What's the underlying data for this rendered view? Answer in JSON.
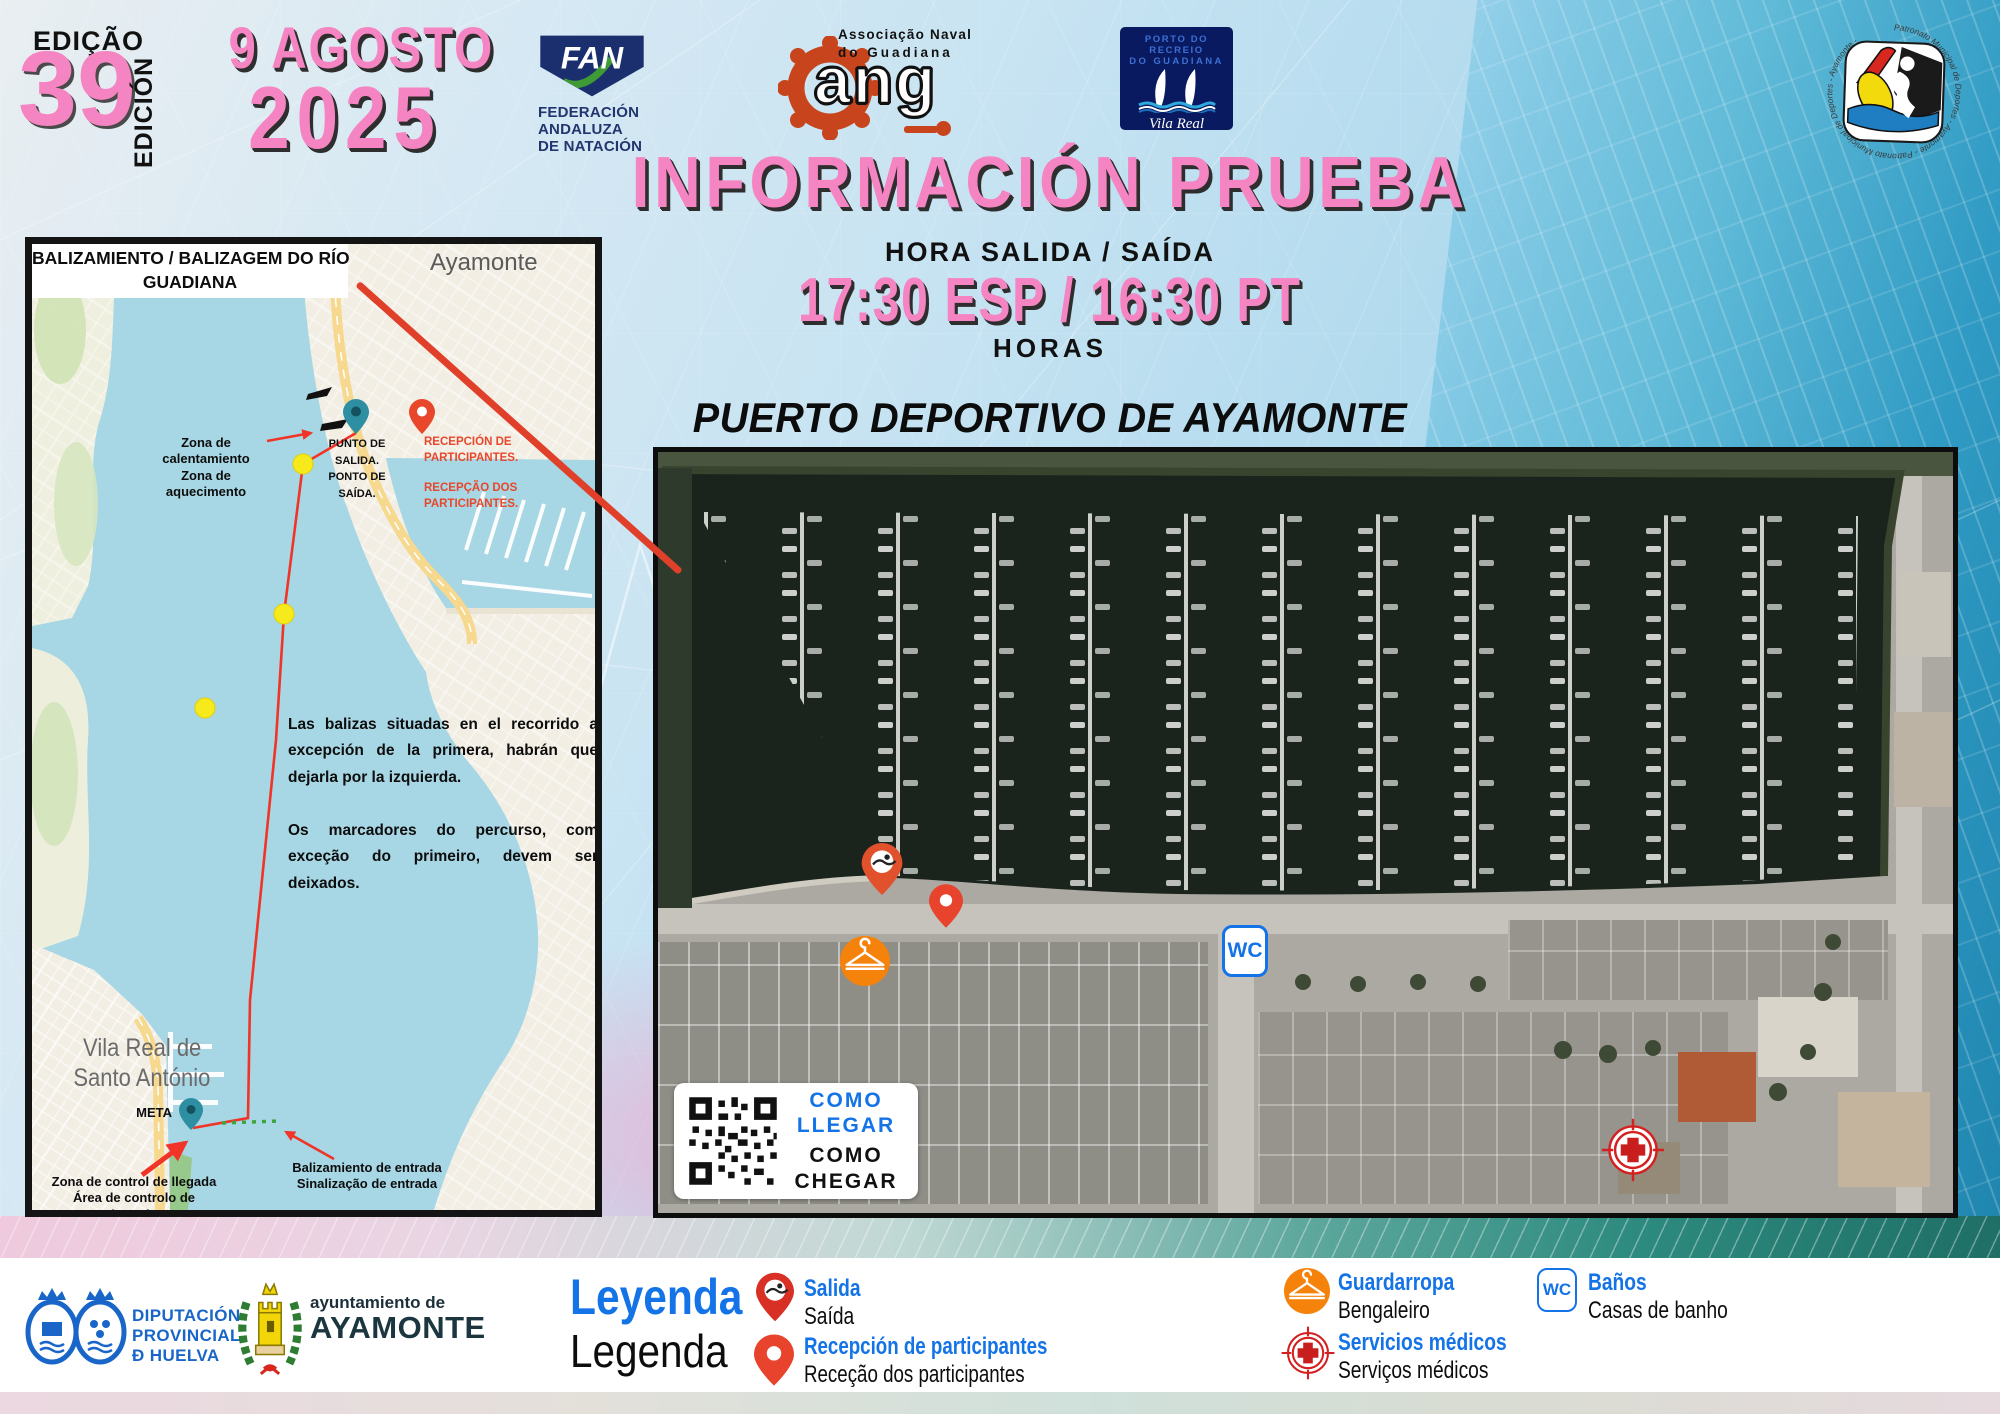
{
  "colors": {
    "pink": "#F584C2",
    "navy": "#1B2F6E",
    "legend_blue": "#1473E6",
    "orange": "#F5820B",
    "pin_red": "#E2402A",
    "teal_pin": "#2E8FA3",
    "route_red": "#F03428",
    "map_water": "#A7D6E4",
    "marina_dark": "#1B241C"
  },
  "edition": {
    "label_top": "EDIÇÃO",
    "number": "39",
    "label_side": "EDICIÓN"
  },
  "event_date": {
    "line1": "9 AGOSTO",
    "line2": "2025"
  },
  "logos": {
    "fan": {
      "acronym": "FAN",
      "line1": "FEDERACIÓN",
      "line2": "ANDALUZA",
      "line3": "DE NATACIÓN"
    },
    "ang": {
      "line1": "Associação Naval",
      "line2": "do Guadiana",
      "acronym": "ang"
    },
    "porto": {
      "line1": "PORTO DO RECREIO",
      "line2": "DO GUADIANA",
      "script": "Vila Real",
      "sub1": "DE SANTO ANTÓNIO",
      "sub2": "ALGARVE"
    },
    "patronato": {
      "circular_text": "Patronato Municipal de Deportes - Ayamonte - Patronato Municipal de Deportes - Ayamonte -"
    },
    "diputacion": {
      "line1": "DIPUTACIÓN",
      "line2": "PROVINCIAL",
      "line3": "Ð HUELVA"
    },
    "ayuntamiento": {
      "line1": "ayuntamiento de",
      "line2": "AYAMONTE"
    }
  },
  "header": {
    "title": "INFORMACIÓN PRUEBA",
    "departure_label": "HORA SALIDA / SAÍDA",
    "departure_time": "17:30 ESP / 16:30 PT",
    "hours_label": "HORAS",
    "venue": "PUERTO DEPORTIVO DE AYAMONTE"
  },
  "route_map": {
    "title_line1": "BALIZAMIENTO / BALIZAGEM DO RÍO",
    "title_line2": "GUADIANA",
    "city_top": "Ayamonte",
    "warmup_es": "Zona de calentamiento",
    "warmup_pt": "Zona de aquecimento",
    "start_l1": "PUNTO DE",
    "start_l2": "SALIDA.",
    "start_l3": "PONTO DE",
    "start_l4": "SAÍDA.",
    "reception_es_l1": "RECEPCIÓN DE",
    "reception_es_l2": "PARTICIPANTES.",
    "reception_pt_l1": "RECEPÇÃO DOS",
    "reception_pt_l2": "PARTICIPANTES.",
    "note_es": "Las balizas situadas en el recorrido a excepción de la primera, habrán que dejarla por la izquierda.",
    "note_pt": "Os marcadores do percurso, com exceção do primeiro, devem ser deixados.",
    "city_bottom_l1": "Vila Real de",
    "city_bottom_l2": "Santo António",
    "meta_label": "META",
    "finish_es": "Zona de control de llegada",
    "finish_pt": "Área de controlo de chegadas",
    "entry_es": "Balizamiento de entrada",
    "entry_pt": "Sinalização de entrada"
  },
  "aerial": {
    "wc_label": "WC",
    "qr_es_l1": "COMO",
    "qr_es_l2": "LLEGAR",
    "qr_pt_l1": "COMO",
    "qr_pt_l2": "CHEGAR"
  },
  "legend": {
    "title_es": "Leyenda",
    "title_pt": "Legenda",
    "wc_label": "WC",
    "items": [
      {
        "es": "Salida",
        "pt": "Saída"
      },
      {
        "es": "Recepción de participantes",
        "pt": "Receção dos participantes"
      },
      {
        "es": "Guardarropa",
        "pt": "Bengaleiro"
      },
      {
        "es": "Servicios médicos",
        "pt": "Serviços médicos"
      },
      {
        "es": "Baños",
        "pt": "Casas de banho"
      }
    ]
  }
}
